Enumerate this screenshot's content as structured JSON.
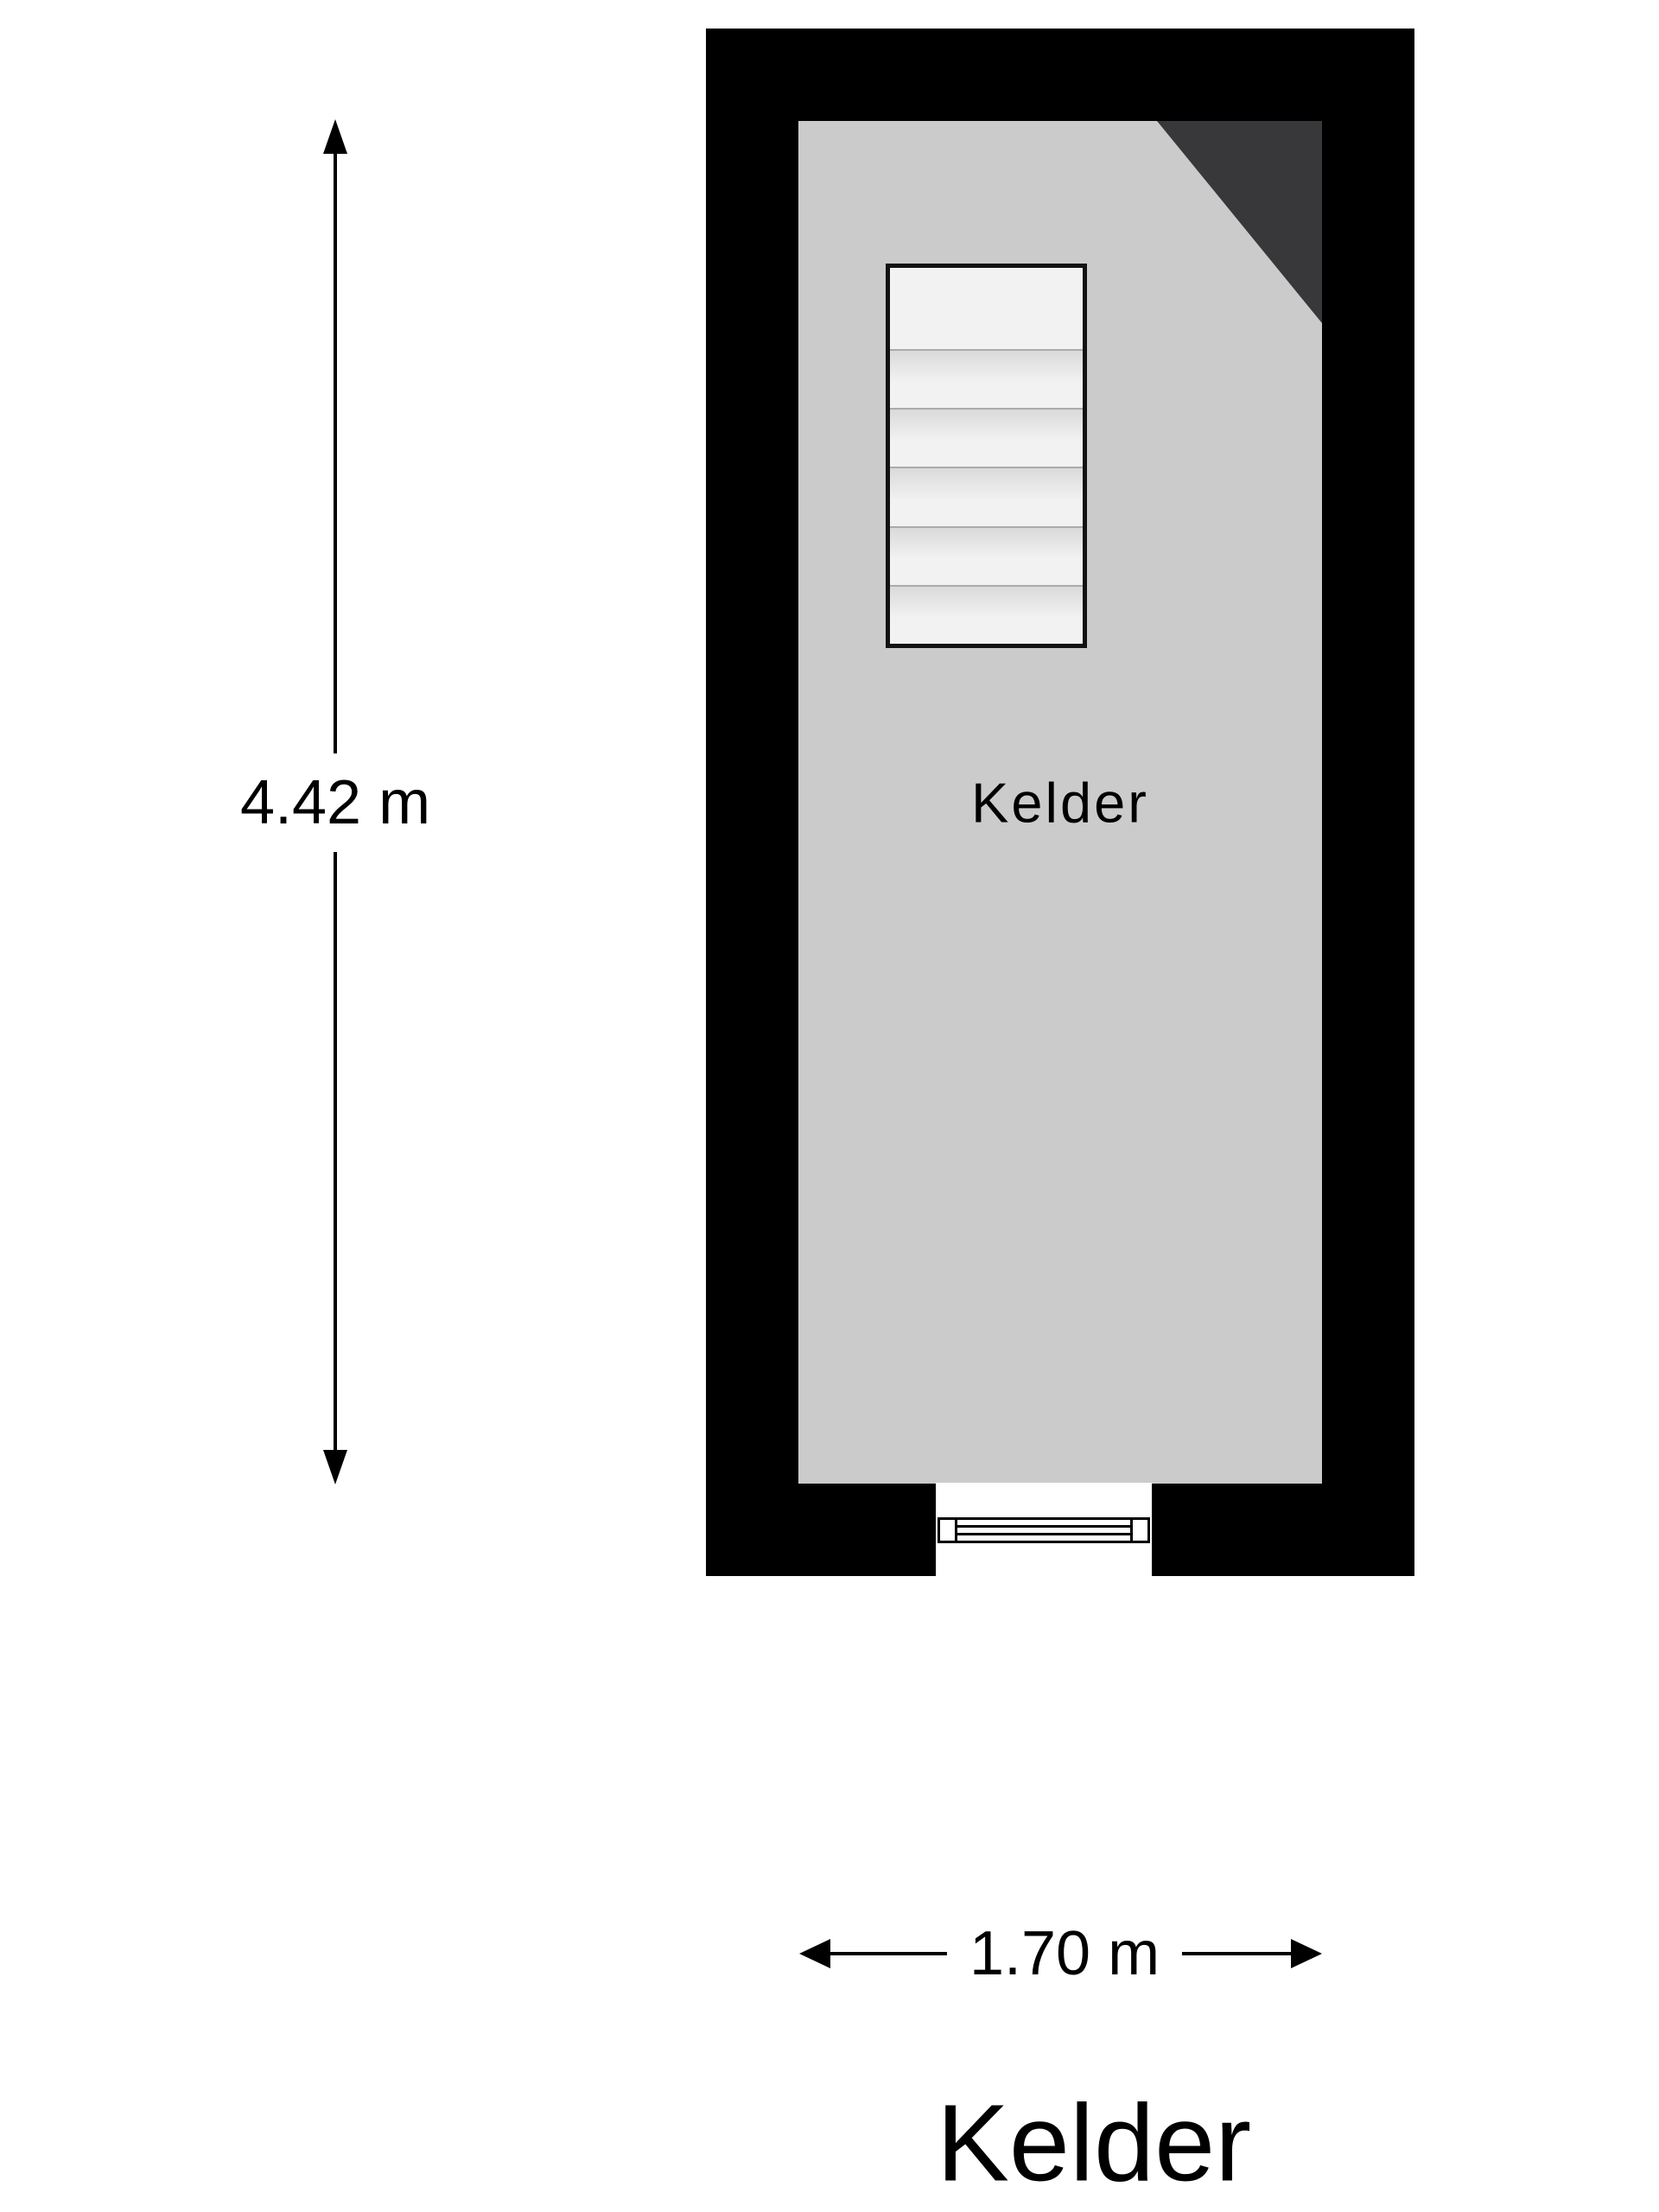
{
  "title": "Kelder",
  "floorplan": {
    "room": {
      "label": "Kelder"
    },
    "staircase": {
      "tread_count": 6
    },
    "has_sloped_corner": true,
    "has_window_in_bottom_wall": true
  },
  "dimensions": {
    "height": {
      "label": "4.42 m"
    },
    "width": {
      "label": "1.70 m"
    }
  },
  "colors": {
    "wall": "#000000",
    "floor": "#cbcbcb",
    "sloped_corner": "#38383b",
    "stair_fill": "#f2f2f2",
    "background": "#ffffff",
    "text": "#000000"
  }
}
